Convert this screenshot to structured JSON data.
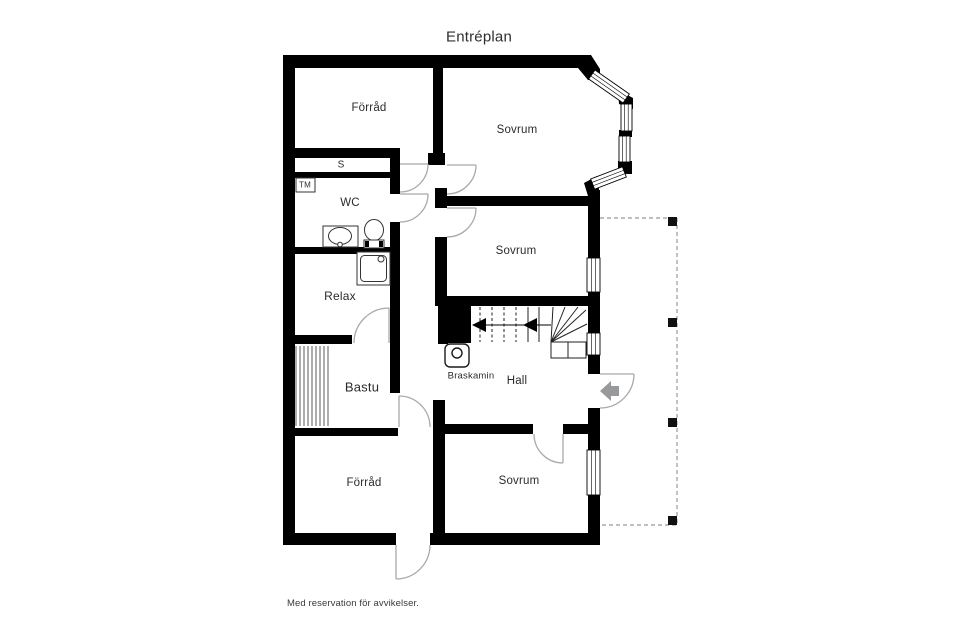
{
  "title": "Entréplan",
  "disclaimer": "Med reservation för avvikelser.",
  "rooms": {
    "forrad_top": "Förråd",
    "sovrum_top": "Sovrum",
    "closet": "S",
    "tm": "TM",
    "wc": "WC",
    "relax": "Relax",
    "sovrum_mid": "Sovrum",
    "bastu": "Bastu",
    "braskamin": "Braskamin",
    "hall": "Hall",
    "forrad_bottom": "Förråd",
    "sovrum_bottom": "Sovrum"
  },
  "colors": {
    "wall": "#000000",
    "door_arc": "#a9a9a9",
    "entry_arrow": "#98999b",
    "terrace_dash": "#999999",
    "stair_line": "#222222",
    "text": "#2b2b2b"
  }
}
